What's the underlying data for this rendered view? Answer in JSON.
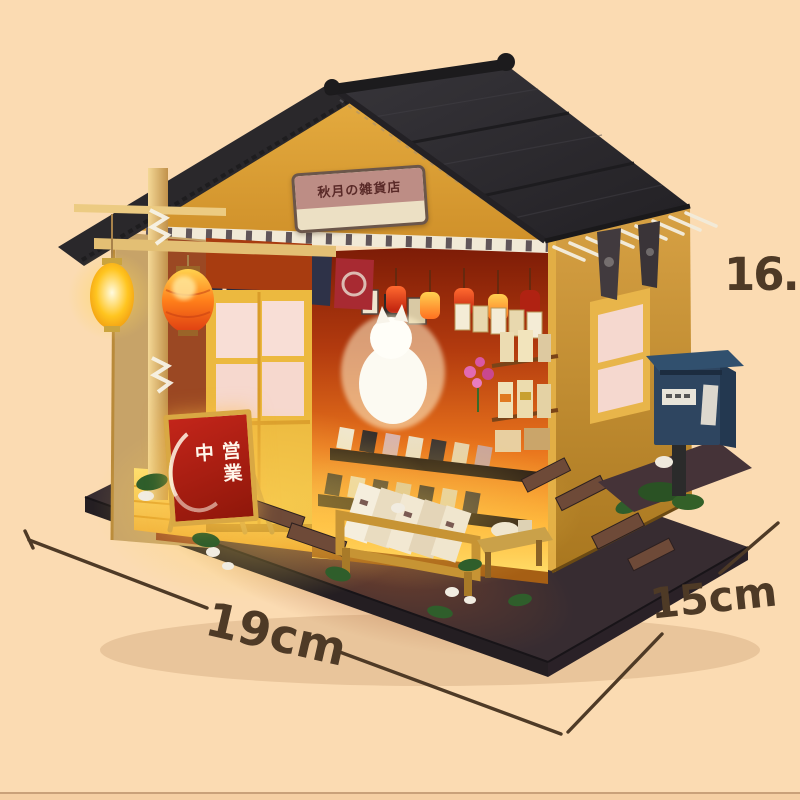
{
  "annotations": {
    "width_label": "19cm",
    "depth_label": "15cm",
    "height_label": "16.5cm"
  },
  "shop": {
    "gable_sign_text": "秋月の雑貨店",
    "open_sign_text": "営業中"
  },
  "palette": {
    "background": "#fbdbb2",
    "bottom-strip": "#f5cfa3",
    "bottom-line": "#c9a179",
    "ink": "#4e3a26",
    "roof": "#2f2d31",
    "gable": "#dda33c",
    "side-wall": "#cf9a3c",
    "door-yellow": "#ecb93f",
    "interior-top": "#7a1a06",
    "glow-yellow": "#ffd95e",
    "lantern-orange": "#e8491c",
    "lantern-yellow": "#ffc832",
    "sign-red": "#c3251a",
    "sign-frame": "#d9a843",
    "mailbox-blue": "#2e4560",
    "base-dark": "#372c31",
    "grass": "#2f5e2b"
  }
}
